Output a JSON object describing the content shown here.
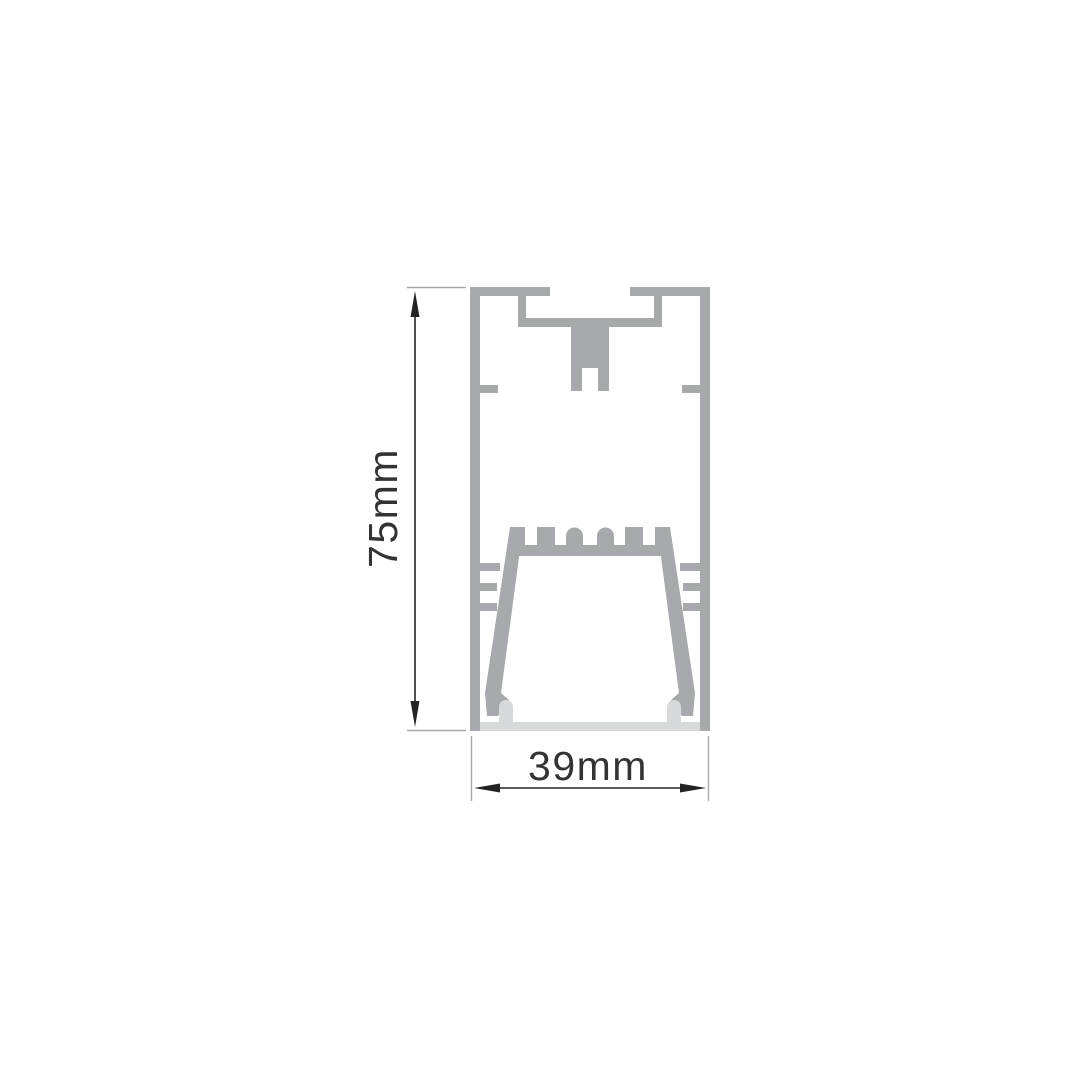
{
  "diagram": {
    "dimensions": {
      "height": {
        "label": "75mm",
        "value_mm": 75
      },
      "width": {
        "label": "39mm",
        "value_mm": 39
      }
    }
  },
  "colors": {
    "background": "#FFFFFF",
    "profile_gray": "#A7A9AC",
    "diffuser_gray": "#D8D9DB",
    "dimension_line": "#232323",
    "extension_line": "#A7A9AC",
    "label_text": "#333333"
  }
}
